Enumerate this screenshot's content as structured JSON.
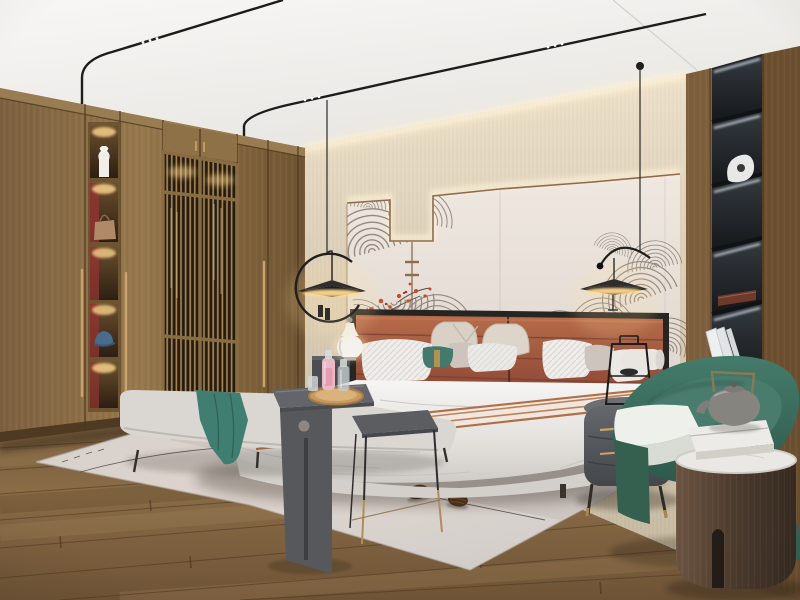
{
  "meta": {
    "title": "Modern Chinese-style bedroom interior",
    "type": "photorealistic interior render, no visible text",
    "canvas": "800x600"
  },
  "palette": {
    "ceiling_white": "#f2f1ef",
    "wallpaper_beige": "#d7ccb8",
    "panel_cream": "#ece5de",
    "panel_trim_brown": "#8f6b4e",
    "mural_line_gray": "#877a6f",
    "blossom_red": "#c7492c",
    "wardrobe_wood": "#8a6c44",
    "niche_back_red": "#8e3530",
    "brass_accent": "#c9a368",
    "lattice_dark": "#241c12",
    "floor_wood": "#7c5f3e",
    "floor_seam": "#4a3722",
    "rug_light": "#d9d0c9",
    "headboard_leather": "#a05a40",
    "bedding_white": "#f1f0ee",
    "teal_accent": "#3f7e71",
    "armchair_green": "#3c6e60",
    "metal_black": "#232323",
    "nightstand_gray": "#54585c",
    "shelf_black": "#22252a",
    "marble_white": "#eae8e4",
    "teapot_gray": "#85847f",
    "warm_glow": "#ffdf9e"
  },
  "scene": {
    "room": "bedroom",
    "style": "modern new-Chinese / Japandi",
    "lighting": [
      "ceiling track spotlights",
      "cove LED above wallpaper",
      "backlit headboard wall panels",
      "warm niche spotlights in wardrobe",
      "LED strips in black display shelves",
      "two black ring pendant lamps"
    ],
    "objects": [
      {
        "name": "wardrobe",
        "desc": "full-height walnut wardrobe with long brass pulls, five lit display niches (vase, handbag, blue cap) with red backs, and two slatted lattice doors"
      },
      {
        "name": "feature-wall",
        "desc": "cream upholstered panels with brown trim dipping in a U, gray swirl line-art mural and red plum blossoms"
      },
      {
        "name": "bed",
        "desc": "white duvet, striped runner, terracotta channel-stitched leather headboard with black frame"
      },
      {
        "name": "pillows",
        "desc": "beige, white striped, gray, teal with brass band, white bolster"
      },
      {
        "name": "pendant-lamps",
        "desc": "black open-ring pendants with flat disc shades, warm underlight, left and right of bed"
      },
      {
        "name": "nightstands",
        "desc": "dark gray rounded cabinets with brass handles; left one holds a white gourd ceramic lamp, right one a black wire lantern object"
      },
      {
        "name": "bench-set",
        "desc": "light gray bench with teal throw, dark gray waterfall side table with round hole, wooden tray with pink perfume bottles, thin-leg nesting table"
      },
      {
        "name": "rug",
        "desc": "large pale pink-gray rug with thin dark curved lines and two pinecones"
      },
      {
        "name": "armchair",
        "desc": "deep green barrel armchair with white seat cushion"
      },
      {
        "name": "drum-table",
        "desc": "dark wood cylinder side table, marble top, white box and gray teapot with brass handle"
      },
      {
        "name": "display-column",
        "desc": "black built-in shelf column with LED strips, white sculpture, red box, leaning white books"
      },
      {
        "name": "floor",
        "desc": "warm oak plank floor"
      }
    ]
  }
}
